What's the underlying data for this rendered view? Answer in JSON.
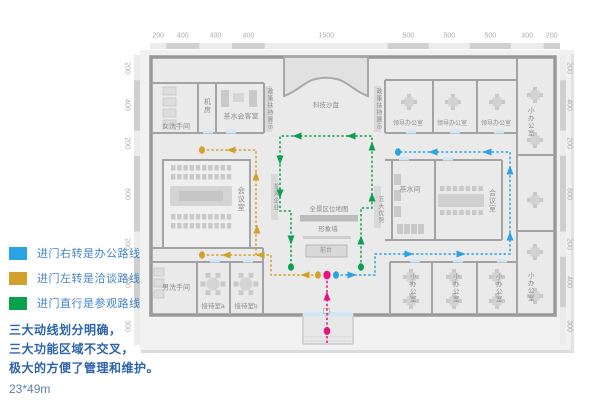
{
  "legend": {
    "items": [
      {
        "key": "office",
        "color": "#29a3e2",
        "label": "进门右转是办公路线"
      },
      {
        "key": "talk",
        "color": "#d2a12c",
        "label": "进门左转是洽谈路线"
      },
      {
        "key": "visit",
        "color": "#0aa14e",
        "label": "进门直行是参观路线"
      }
    ]
  },
  "notes": [
    "三大动线划分明确，",
    "三大功能区域不交叉，",
    "极大的方便了管理和维护。"
  ],
  "size_label": "23*49m",
  "dims": {
    "top": [
      "200",
      "400",
      "400",
      "400",
      "1500",
      "500",
      "500",
      "500",
      "400",
      "200"
    ],
    "side": [
      "200",
      "400",
      "200",
      "600",
      "200",
      "400",
      "300"
    ]
  },
  "rooms": {
    "wc_women": "女洗手间",
    "server_room": "机房",
    "tea_reception": "茶水会客室",
    "tech_sandbox": "科技沙盘",
    "policy_left": "政策扶持展示",
    "policy_right": "政策扶持展示",
    "leading_firms": "龙头企业",
    "five_advantages": "五大优势",
    "panorama_map": "全景区位地图",
    "image_wall": "形象墙",
    "front_desk": "前台",
    "meeting_left": "会议室",
    "tea_right": "茶水间",
    "meeting_right": "会议室",
    "leader_office": "领导办公室",
    "small_office": "小办公室",
    "wc_men": "男洗手间",
    "reception_a": "接待室a",
    "reception_b": "接待室b"
  },
  "colors": {
    "blue": "#29a3e2",
    "gold": "#d2a12c",
    "green": "#0aa14e",
    "pink": "#e8117d",
    "wall": "#a3a3a3",
    "building_fill": "#eaeaea",
    "backdrop": "#f1f1f1",
    "door": "#cfe8f5",
    "furniture": "#c9c9c9",
    "dim_dark": "#cfcfcf",
    "dim_light": "#ececec"
  }
}
